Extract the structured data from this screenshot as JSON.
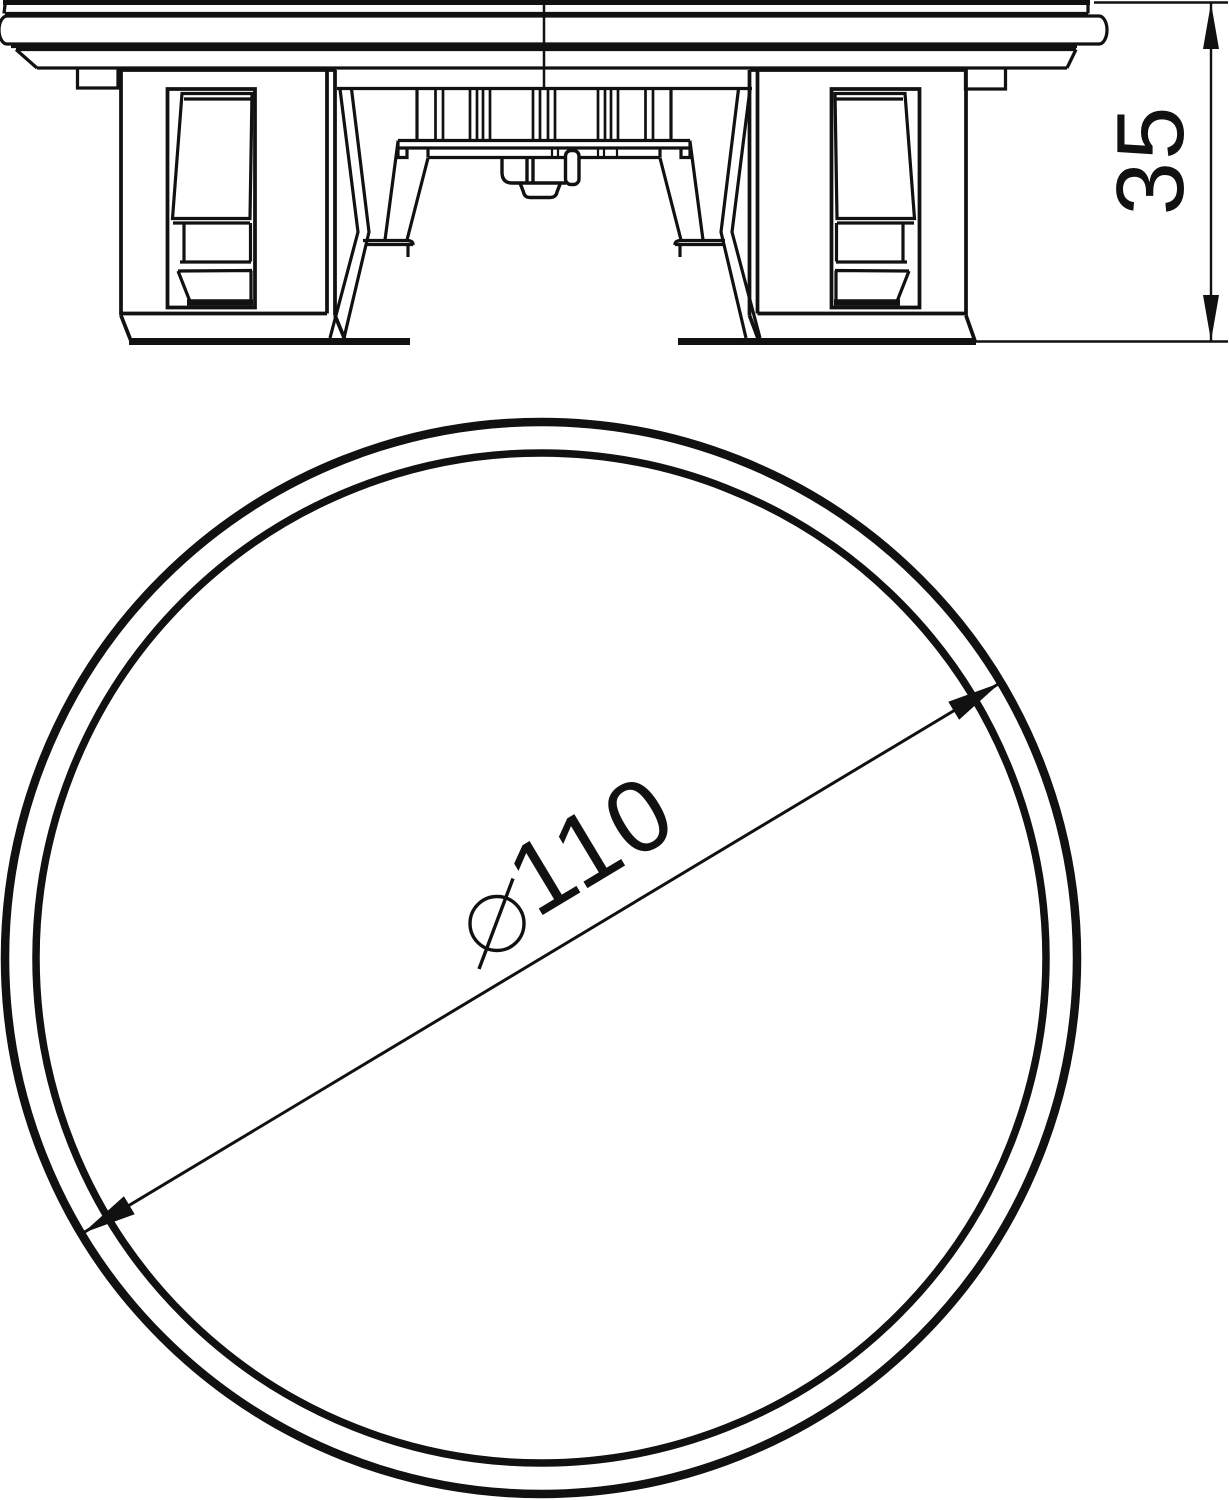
{
  "page": {
    "type": "technical-drawing",
    "background": "#ffffff",
    "line_color": "#111111"
  },
  "side_view": {
    "description": "side elevation of round cover with mounting feet",
    "height_dimension": "35"
  },
  "plan_view": {
    "description": "plan view, two concentric circles with diagonal diameter dimension",
    "diameter_symbol": "⌀",
    "diameter_dimension": "110",
    "diameter_full_label": "⌀110"
  }
}
